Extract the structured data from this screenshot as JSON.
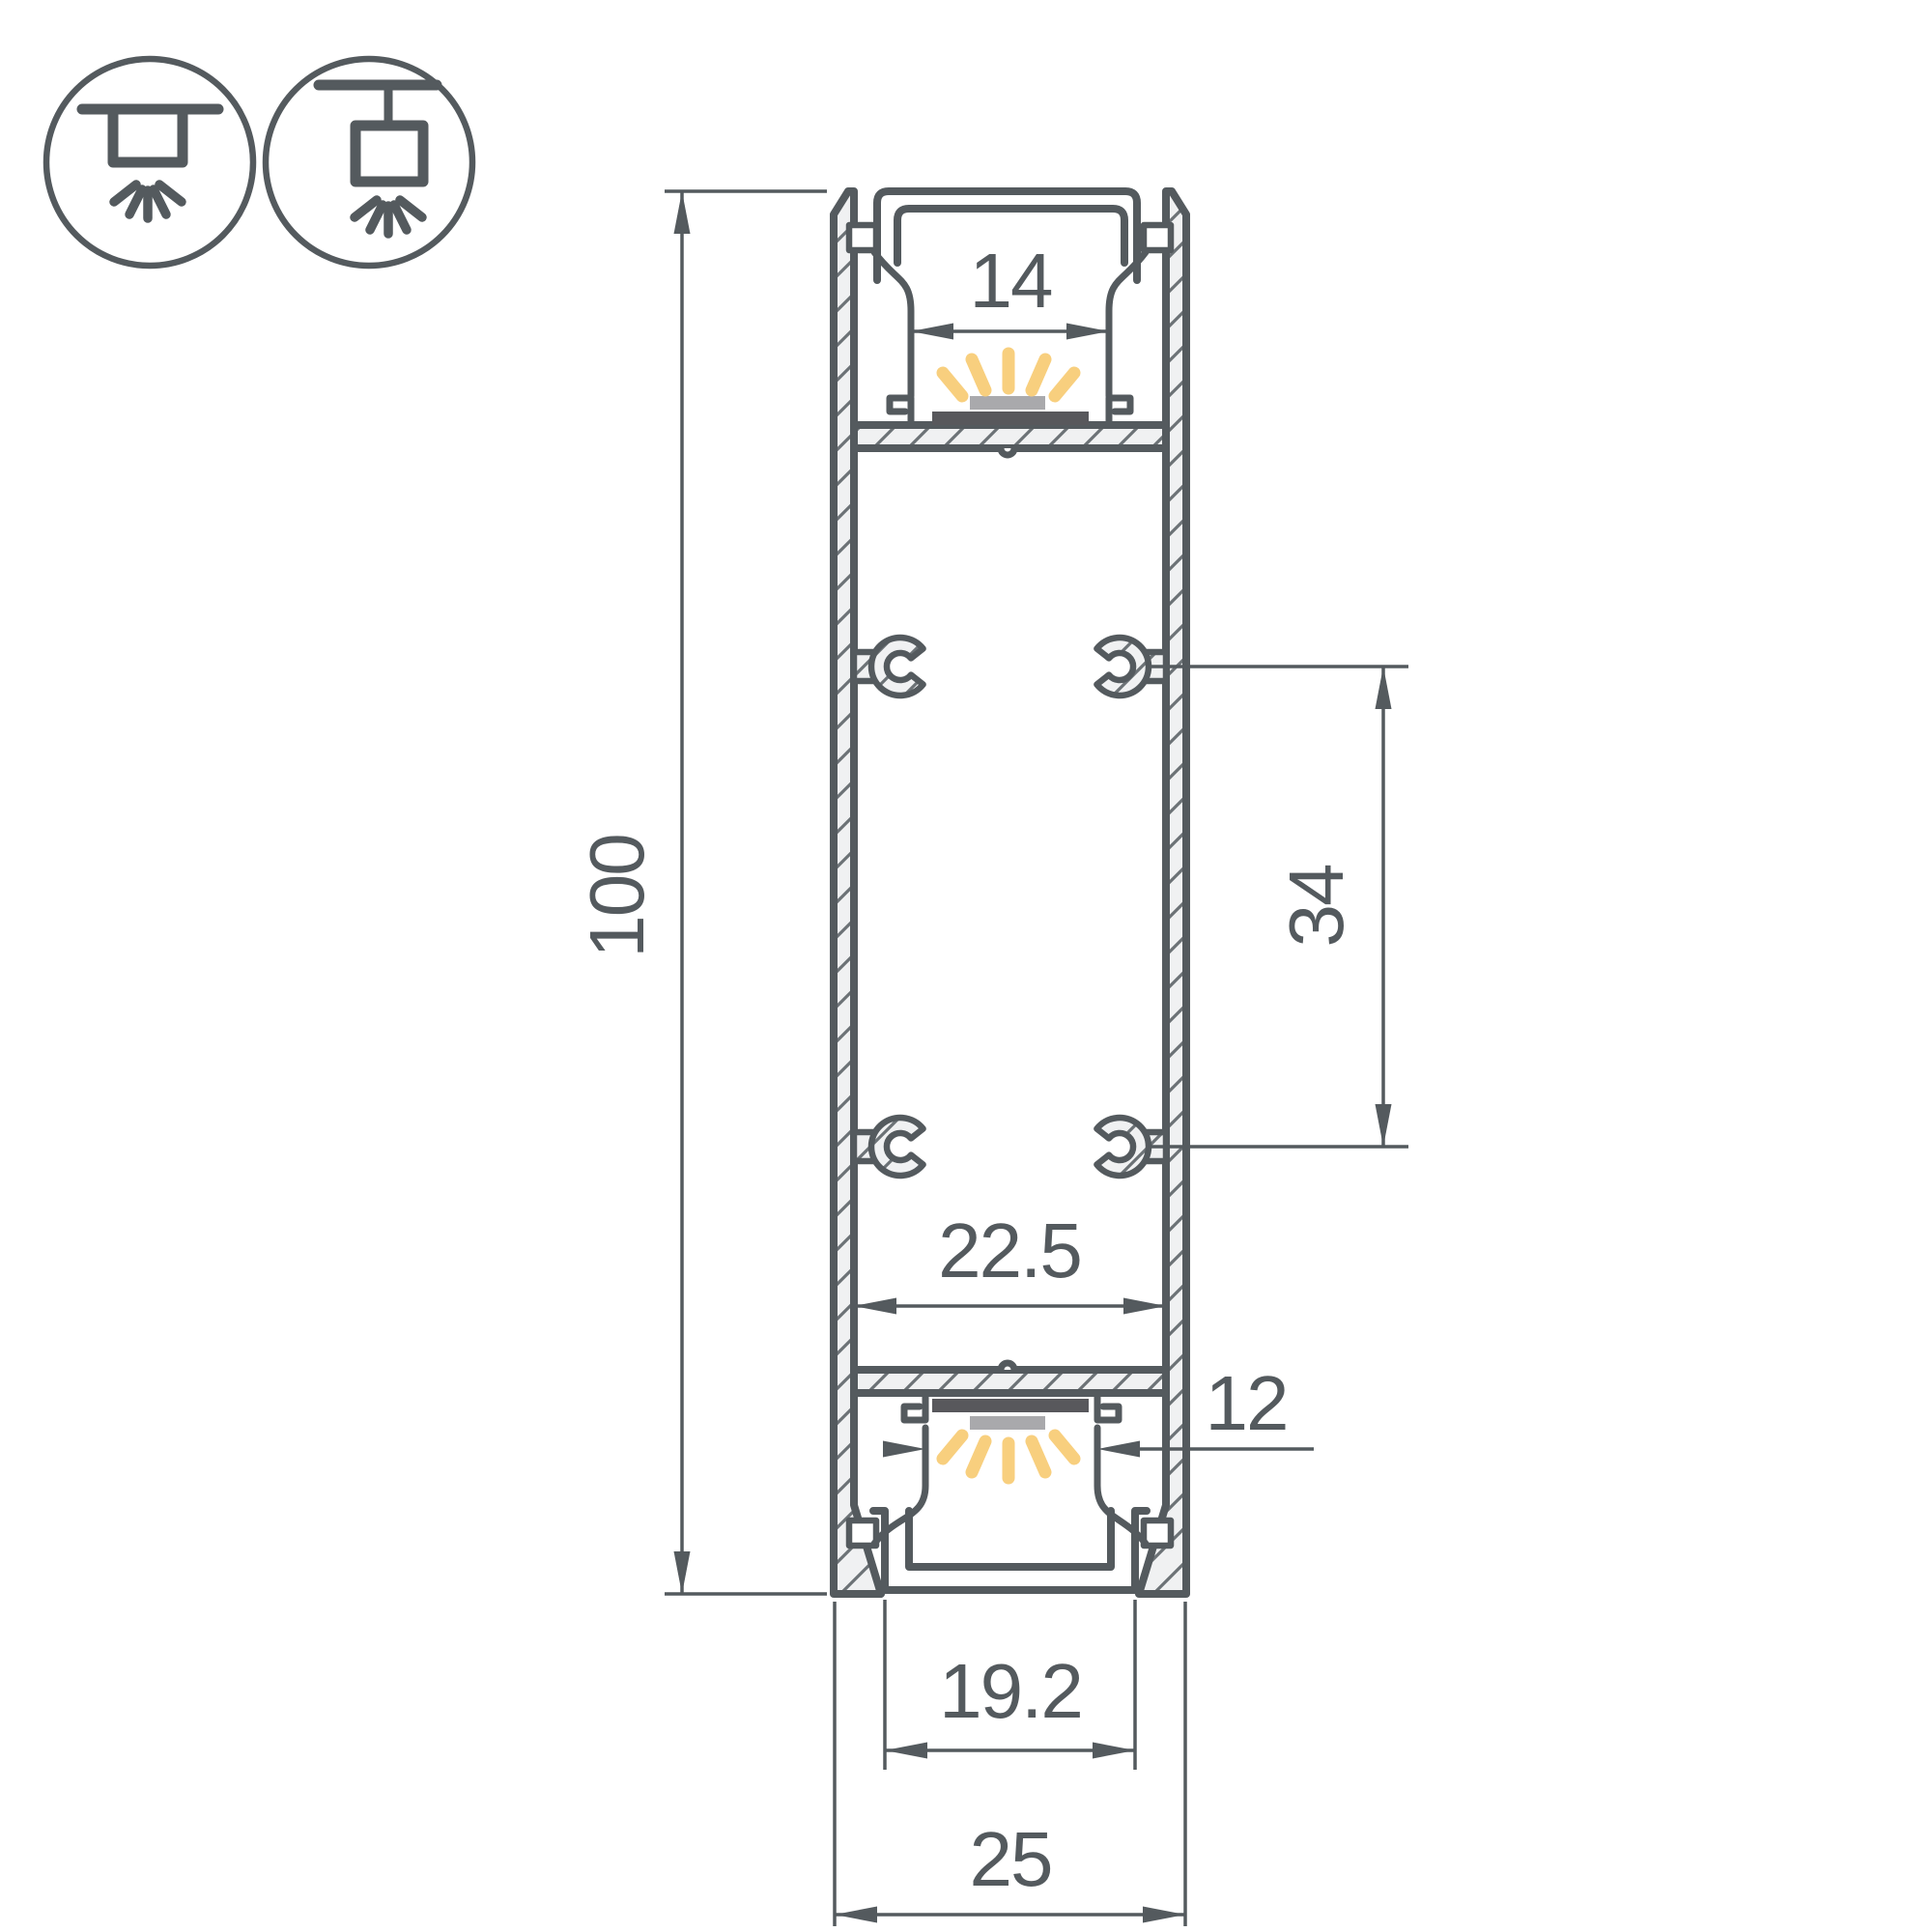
{
  "drawing": {
    "type": "led-profile-cross-section",
    "icons": [
      {
        "name": "surface-mount-icon"
      },
      {
        "name": "suspended-mount-icon"
      }
    ],
    "dimensions": {
      "overall_height": "100",
      "top_opening_width": "14",
      "boss_spacing": "34",
      "inner_width": "22.5",
      "bottom_opening_width": "12",
      "bottom_cover_width": "19.2",
      "overall_width": "25"
    },
    "colors": {
      "line": "#545a5e",
      "hatch_fill": "#f0f1f2",
      "hatch_line": "#6c7276",
      "led_strip": "#58585c",
      "led_emitter": "#a9a9ac",
      "light_rays": "#f8cf7e",
      "background": "#ffffff"
    }
  }
}
